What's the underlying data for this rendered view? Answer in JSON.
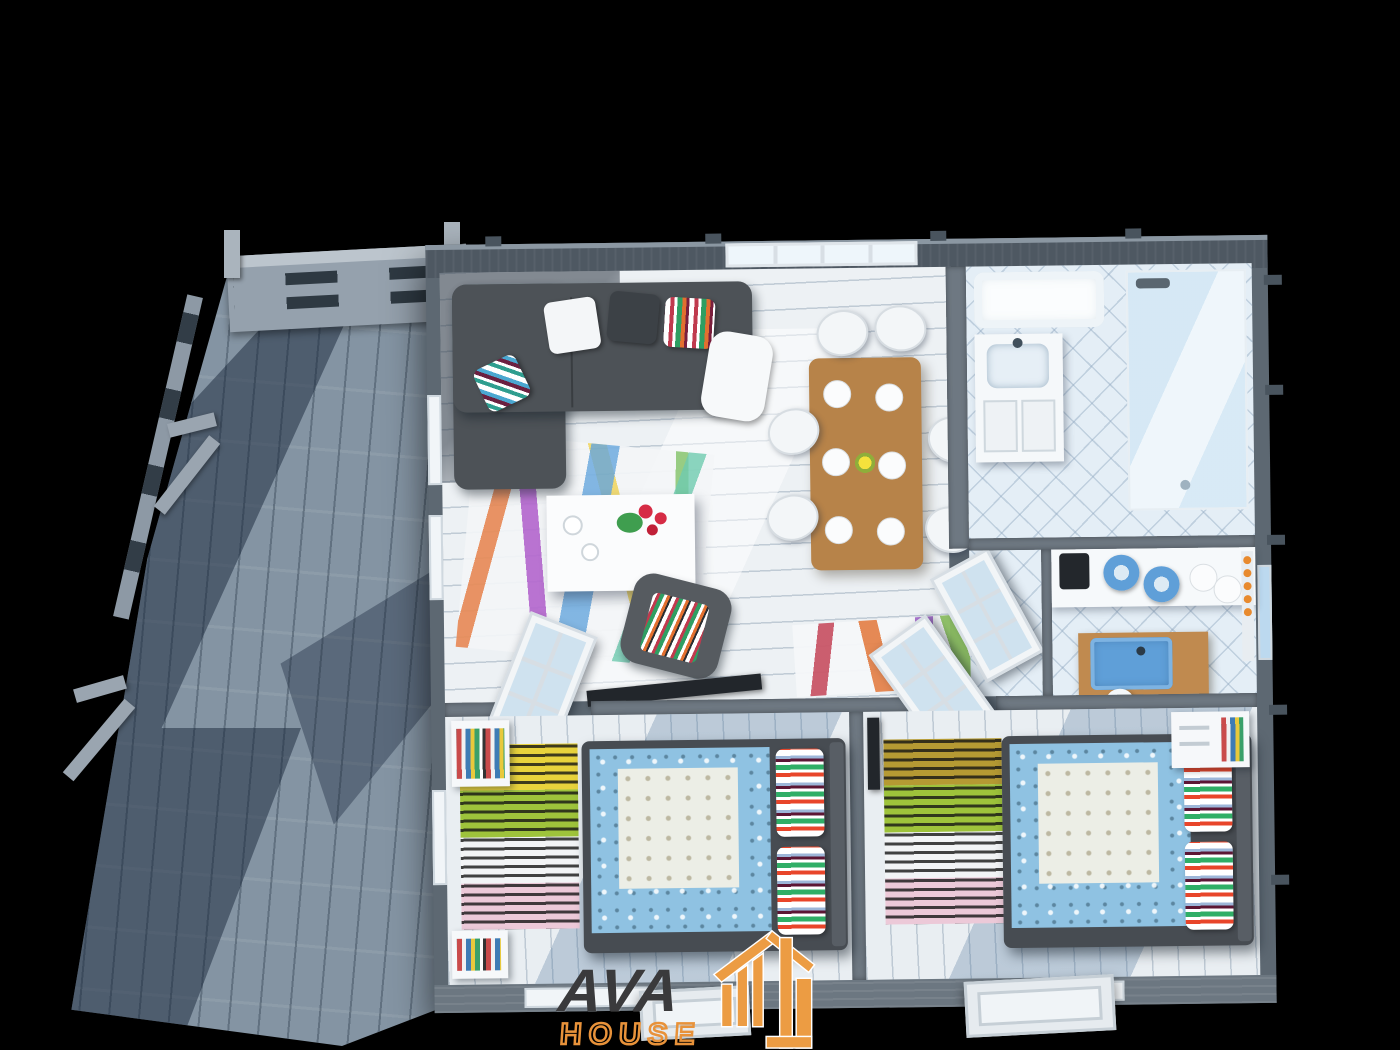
{
  "scene": {
    "type": "3d-top-down-cutaway-floorplan-render",
    "subject": "single-story wooden cabin with furnished interior and side terrace",
    "background_color": "#000000"
  },
  "logo": {
    "line1": "AVA",
    "line2": "HOUSE",
    "line1_color": "#3a3a3c",
    "line2_color": "#e8923a",
    "icon": "plank-house-icon",
    "icon_color": "#ec9c43"
  },
  "palette": {
    "deck_wood": "#8494a3",
    "deck_shadow": "#18263a",
    "exterior_wall": "#5d6872",
    "front_wall": "#6c7781",
    "interior_floor": "#edf1f4",
    "tile_floor": "#e4eef6",
    "table_wood": "#b78349",
    "counter_wood": "#c08a4f",
    "sofa_gray": "#4d5257",
    "bed_blue": "#8fc2e2",
    "sink_blue": "#5f9fd8",
    "rug_stripe_colors": [
      "#c23b4e",
      "#e2702f",
      "#9b59c8",
      "#7db84a",
      "#5aa7d6",
      "#68c9b8",
      "#f0d24d"
    ]
  },
  "rooms": [
    {
      "name": "terrace-deck"
    },
    {
      "name": "living-room"
    },
    {
      "name": "dining-area"
    },
    {
      "name": "bathroom"
    },
    {
      "name": "kitchen"
    },
    {
      "name": "entry-hall"
    },
    {
      "name": "bedroom-1"
    },
    {
      "name": "bedroom-2"
    }
  ]
}
